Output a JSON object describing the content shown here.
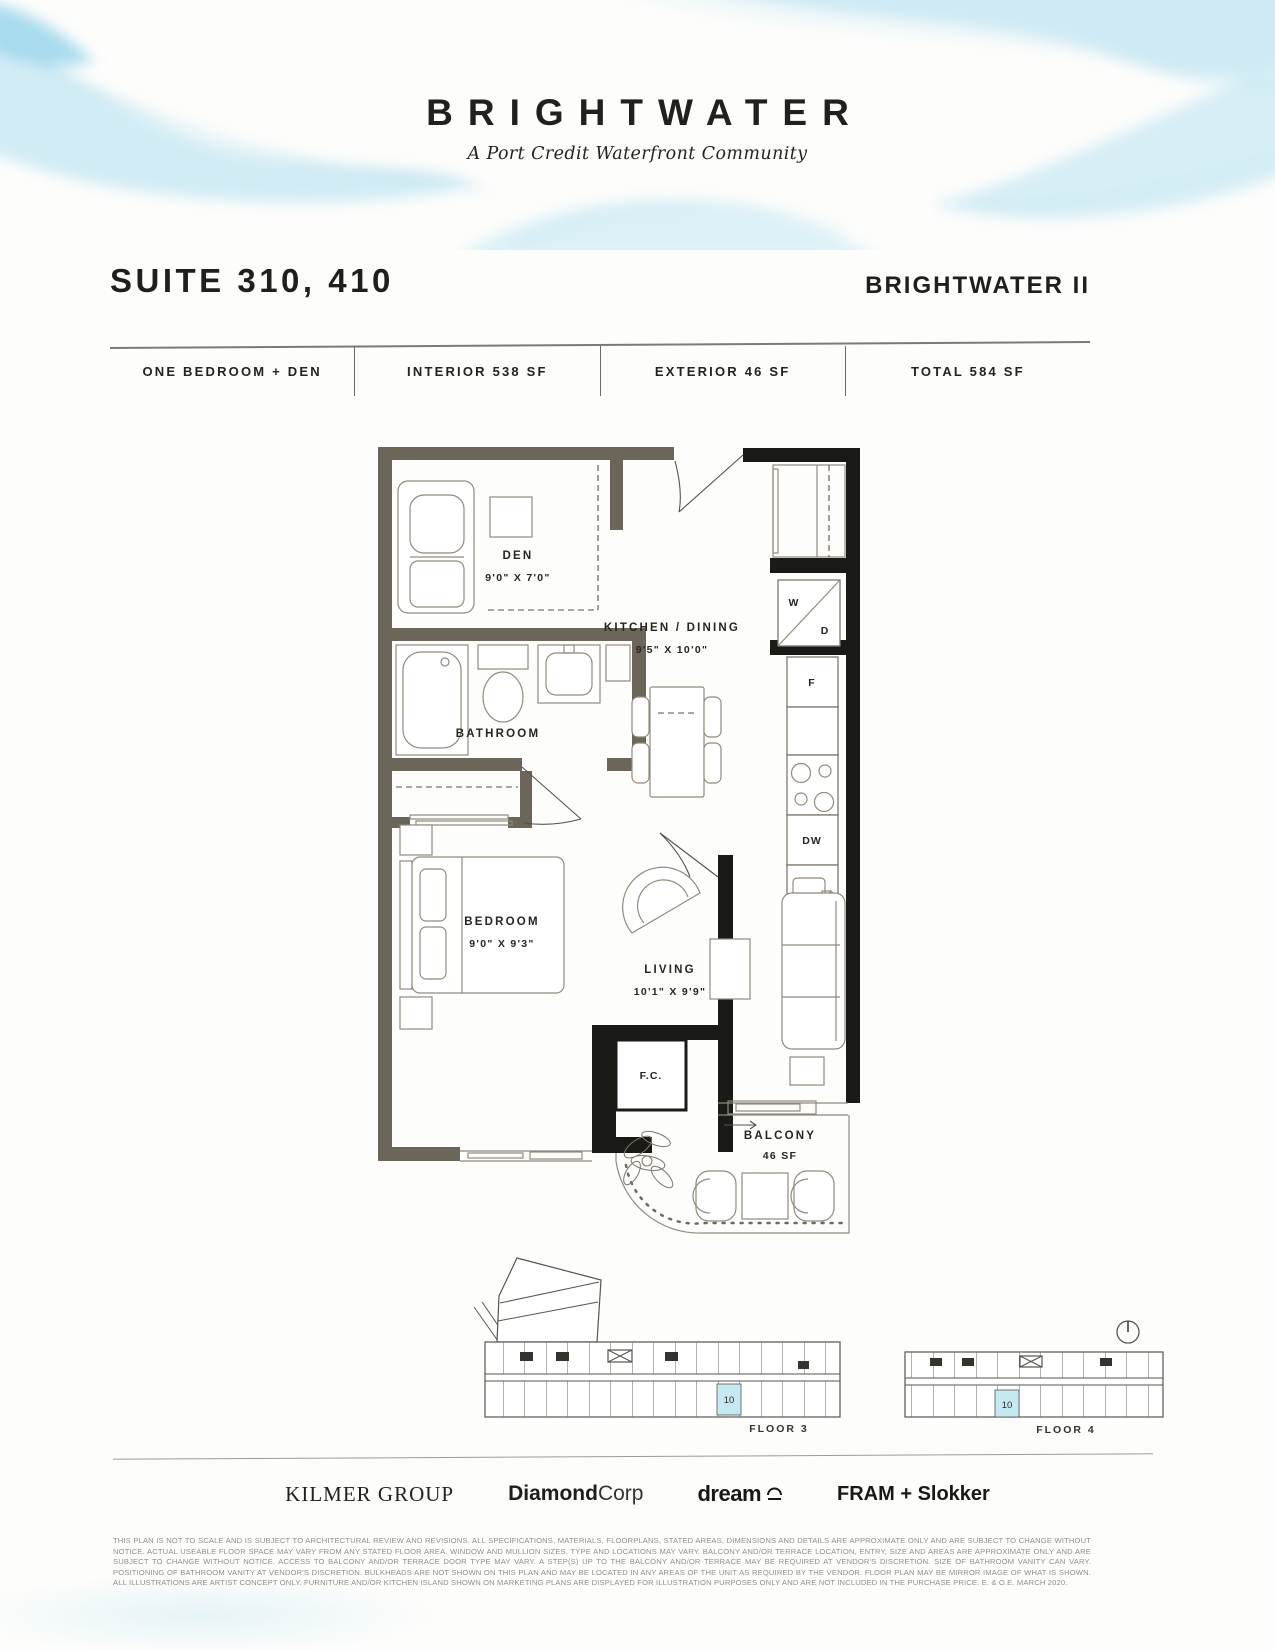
{
  "header": {
    "brand": "BRIGHTWATER",
    "tagline": "A Port Credit Waterfront Community"
  },
  "title_block": {
    "suite_label": "SUITE 310, 410",
    "project_label": "BRIGHTWATER II"
  },
  "spec_bar": {
    "columns": [
      "ONE BEDROOM + DEN",
      "INTERIOR 538 SF",
      "EXTERIOR 46 SF",
      "TOTAL 584 SF"
    ]
  },
  "floorplan": {
    "den": {
      "name": "DEN",
      "dims": "9'0\" X 7'0\""
    },
    "bathroom": {
      "name": "BATHROOM"
    },
    "kitchen_dining": {
      "name": "KITCHEN / DINING",
      "dims": "9'5\" X 10'0\""
    },
    "bedroom": {
      "name": "BEDROOM",
      "dims": "9'0\" X 9'3\""
    },
    "living": {
      "name": "LIVING",
      "dims": "10'1\" X 9'9\""
    },
    "balcony": {
      "name": "BALCONY",
      "dims": "46 SF"
    },
    "fan_coil": "F.C.",
    "washer": "W",
    "dryer": "D",
    "fridge": "F",
    "dishwasher": "DW"
  },
  "keyplans": {
    "floor3": {
      "label": "FLOOR 3",
      "unit": "10"
    },
    "floor4": {
      "label": "FLOOR 4",
      "unit": "10"
    },
    "highlight_color": "#c4e9f2"
  },
  "partners": {
    "kilmer": "KILMER GROUP",
    "diamond_bold": "Diamond",
    "diamond_light": "Corp",
    "dream": "dream",
    "fram": "FRAM + Slokker"
  },
  "colors": {
    "watercolor": "#bfe4f0",
    "unit_highlight": "#c4e9f2"
  },
  "disclaimer": "THIS PLAN IS NOT TO SCALE AND IS SUBJECT TO ARCHITECTURAL REVIEW AND REVISIONS. ALL SPECIFICATIONS, MATERIALS, FLOORPLANS, STATED AREAS, DIMENSIONS AND DETAILS ARE APPROXIMATE ONLY AND ARE SUBJECT TO CHANGE WITHOUT NOTICE. ACTUAL USEABLE FLOOR SPACE MAY VARY FROM ANY STATED FLOOR AREA. WINDOW AND MULLION SIZES, TYPE AND LOCATIONS MAY VARY. BALCONY AND/OR TERRACE LOCATION, ENTRY, SIZE AND AREAS ARE APPROXIMATE ONLY AND ARE SUBJECT TO CHANGE WITHOUT NOTICE. ACCESS TO BALCONY AND/OR TERRACE DOOR TYPE MAY VARY. A STEP(S) UP TO THE BALCONY AND/OR TERRACE MAY BE REQUIRED AT VENDOR'S DISCRETION. SIZE OF BATHROOM VANITY CAN VARY. POSITIONING OF BATHROOM VANITY AT VENDOR'S DISCRETION. BULKHEADS ARE NOT SHOWN ON THIS PLAN AND MAY BE LOCATED IN ANY AREAS OF THE UNIT AS REQUIRED BY THE VENDOR. FLOOR PLAN MAY BE MIRROR IMAGE OF WHAT IS SHOWN. ALL ILLUSTRATIONS ARE ARTIST CONCEPT ONLY. FURNITURE AND/OR KITCHEN ISLAND SHOWN ON MARKETING PLANS ARE DISPLAYED FOR ILLUSTRATION PURPOSES ONLY AND ARE NOT INCLUDED IN THE PURCHASE PRICE. E. & O.E. MARCH 2020."
}
